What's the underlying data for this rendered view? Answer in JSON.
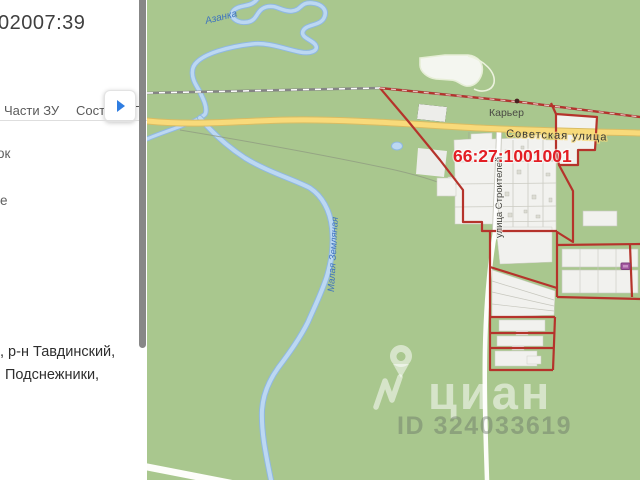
{
  "panel": {
    "title": "02007:39",
    "tabs": {
      "tab1": "Части ЗУ",
      "tab2": "Соста",
      "tab3": "П"
    },
    "fragments": {
      "f1": "ок",
      "f2": "е"
    },
    "address": {
      "line1": ", р-н Тавдинский,",
      "line2": "Подснежники,"
    }
  },
  "map": {
    "labels": {
      "river_top": "Азанка",
      "river_main": "Малая Земляная",
      "quarry": "Карьер",
      "street_main": "Советская улица",
      "street_side": "улица Строителей",
      "quarter_number": "66:27:1001001"
    },
    "watermark": {
      "brand": "циан",
      "id": "ID 324033619"
    },
    "colors": {
      "land": "#a9c78e",
      "river": "#b9d7f2",
      "road_fill": "#f8da7a",
      "boundary_red": "#b5332b",
      "label_red": "#e31e24",
      "marker_purple": "#a2589f"
    }
  }
}
